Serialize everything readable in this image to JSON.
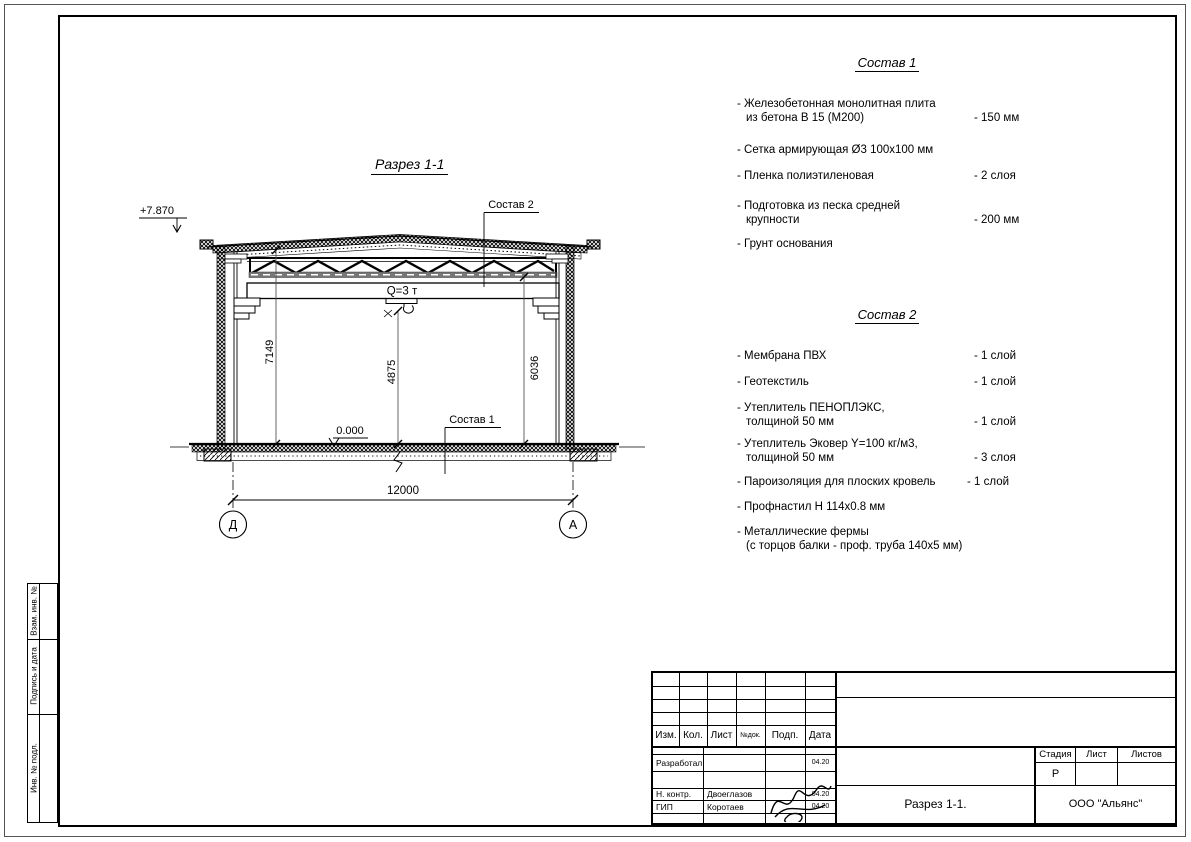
{
  "frame": {
    "side_strip": [
      "Взам. инв. №",
      "Подпись и дата",
      "Инв. № подл."
    ]
  },
  "drawing": {
    "title": "Разрез 1-1",
    "elevation": "+7.870",
    "zero_level": "0.000",
    "crane": "Q=3 т",
    "label_sostav1": "Состав 1",
    "label_sostav2": "Состав 2",
    "dim_height_left": "7149",
    "dim_height_center": "4875",
    "dim_height_right": "6036",
    "dim_span": "12000",
    "axis_left": "Д",
    "axis_right": "А"
  },
  "sostav1": {
    "title": "Состав 1",
    "items": [
      {
        "line1": "- Железобетонная  монолитная плита",
        "line2": "из бетона В 15 (М200)",
        "value": "- 150 мм"
      },
      {
        "line1": "- Сетка армирующая Ø3 100x100 мм",
        "line2": "",
        "value": ""
      },
      {
        "line1": "- Пленка полиэтиленовая",
        "line2": "",
        "value": "- 2 слоя"
      },
      {
        "line1": "- Подготовка из песка средней",
        "line2": "крупности",
        "value": "- 200 мм"
      },
      {
        "line1": "- Грунт основания",
        "line2": "",
        "value": ""
      }
    ]
  },
  "sostav2": {
    "title": "Состав 2",
    "items": [
      {
        "line1": "- Мембрана ПВХ",
        "line2": "",
        "value": "- 1 слой"
      },
      {
        "line1": "- Геотекстиль",
        "line2": "",
        "value": "- 1 слой"
      },
      {
        "line1": "- Утеплитель ПЕНОПЛЭКС,",
        "line2": "толщиной 50 мм",
        "value": "- 1 слой"
      },
      {
        "line1": "- Утеплитель Эковер Y=100 кг/м3,",
        "line2": "толщиной 50 мм",
        "value": "- 3 слоя"
      },
      {
        "line1": "- Пароизоляция для плоских кровель",
        "line2": "",
        "value": "- 1 слой"
      },
      {
        "line1": "- Профнастил Н 114х0.8 мм",
        "line2": "",
        "value": ""
      },
      {
        "line1": "- Металлические фермы",
        "line2": "(с торцов балки - проф. труба 140х5 мм)",
        "value": ""
      }
    ]
  },
  "title_block": {
    "cols": [
      "Изм.",
      "Кол.",
      "Лист",
      "№док.",
      "Подп.",
      "Дата"
    ],
    "rows": [
      {
        "role": "Разработал",
        "name": "",
        "date": "04.20"
      },
      {
        "role": "Н. контр.",
        "name": "Двоеглазов",
        "date": "04.20"
      },
      {
        "role": "ГИП",
        "name": "Коротаев",
        "date": "04.20"
      }
    ],
    "stage_label": "Стадия",
    "sheet_label": "Лист",
    "sheets_label": "Листов",
    "stage_value": "Р",
    "doc_name": "Разрез 1-1.",
    "company": "ООО \"Альянс\""
  }
}
